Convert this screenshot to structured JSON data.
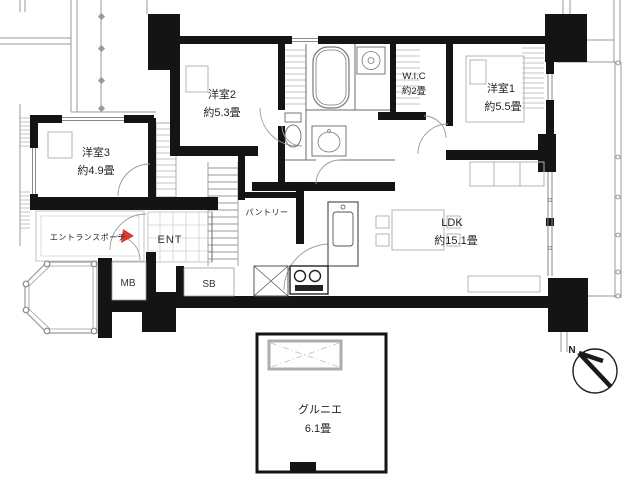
{
  "rooms": {
    "yoshitsu2": {
      "name": "洋室2",
      "size": "約5.3畳"
    },
    "yoshitsu1": {
      "name": "洋室1",
      "size": "約5.5畳"
    },
    "yoshitsu3": {
      "name": "洋室3",
      "size": "約4.9畳"
    },
    "wic": {
      "name": "W.I.C",
      "size": "約2畳"
    },
    "ldk": {
      "name": "LDK",
      "size": "約15.1畳"
    },
    "grenier": {
      "name": "グルニエ",
      "size": "6.1畳"
    }
  },
  "labels": {
    "entrance_porch": "エントランスポーチ",
    "entrance": "ENT",
    "pantry": "パントリー",
    "meter_box": "MB",
    "shoe_box": "SB",
    "north": "N"
  },
  "colors": {
    "wall": "#141414",
    "thin_line": "#9a9a9a",
    "furniture_line": "#b4b4b4",
    "fixture_line": "#6b6b6b",
    "entrance_arrow": "#d93a2b"
  }
}
